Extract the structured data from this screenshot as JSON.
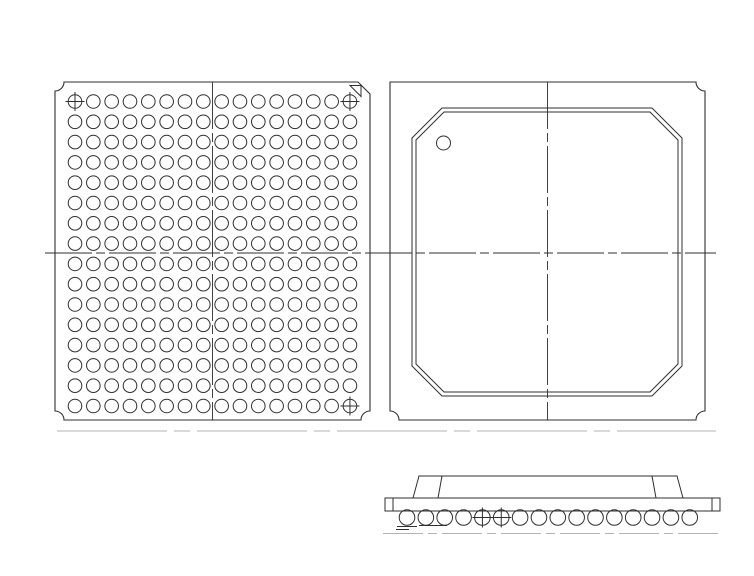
{
  "package_drawing": {
    "background_color": "#ffffff",
    "line_color": "#2f2f2f",
    "phantom_line_color": "#b3b3b3",
    "views": {
      "bottom_view": {
        "label": "ball-grid-bottom-view",
        "rows": 16,
        "cols": 16,
        "total_balls": 256,
        "crossed_cells": [
          [
            0,
            0
          ],
          [
            0,
            15
          ],
          [
            15,
            15
          ]
        ],
        "corner_marker": "a1-triangle",
        "notched_corners": [
          "top-left",
          "bottom-left",
          "bottom-right"
        ],
        "chamfered_corner": "top-right"
      },
      "top_view": {
        "label": "package-top-view",
        "body_outline": "chamfered-square-double-line",
        "pin1_marker": "circle",
        "notched_corners": [
          "top-right",
          "bottom-left",
          "bottom-right"
        ]
      },
      "side_view": {
        "label": "package-side-view",
        "ball_count": 16,
        "crossed_ball_indices": [
          4,
          5
        ],
        "parts": [
          "mold-cap",
          "substrate",
          "solder-balls",
          "seating-plane-marks"
        ]
      }
    }
  }
}
